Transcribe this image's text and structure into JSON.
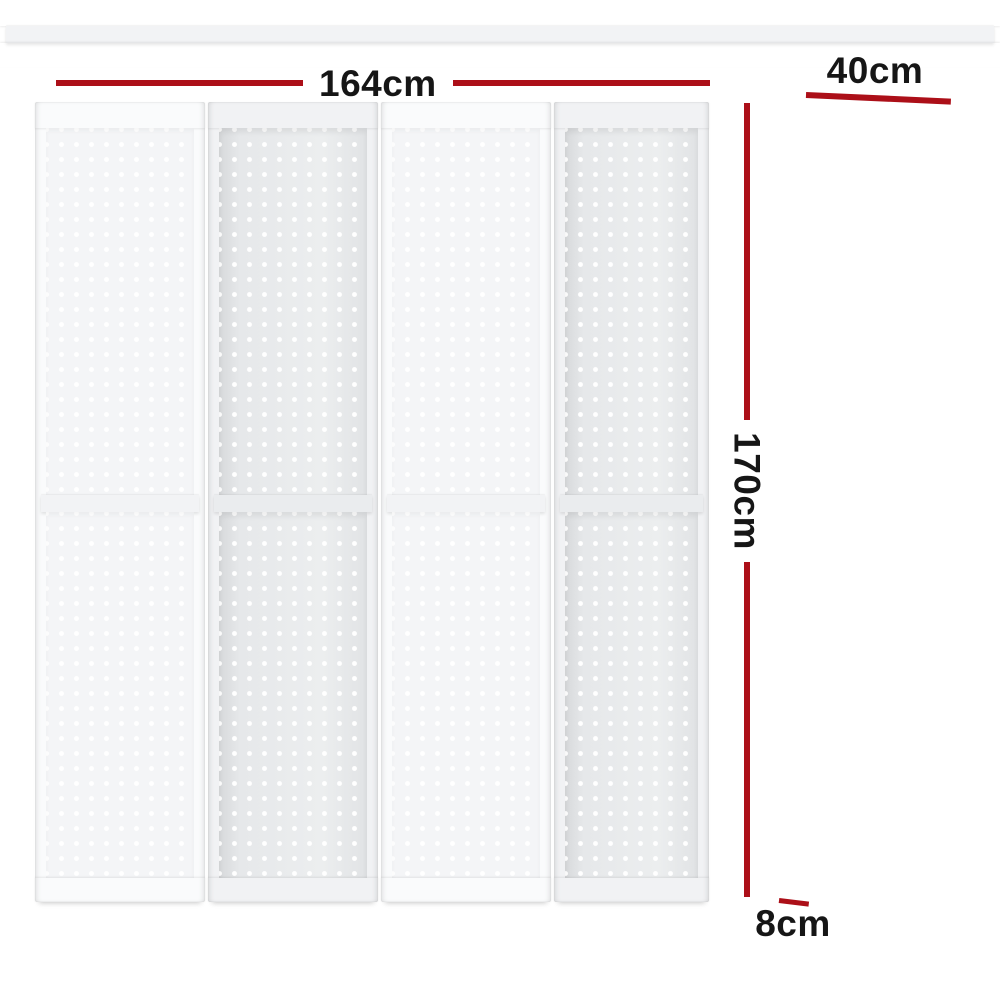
{
  "image": {
    "type": "product dimension diagram",
    "subject": "white 4-panel pegboard folding room divider, front view and folded side view"
  },
  "dimensions": {
    "width": "164cm",
    "panel_width": "40cm",
    "height": "170cm",
    "depth": "8cm"
  },
  "views": {
    "front": {
      "panel_count": 4
    },
    "side": {
      "hinge_sets": 2
    }
  },
  "colors": {
    "dimension_line": "#ac0f18",
    "dimension_text": "#161616",
    "panel_white": "#f4f5f7",
    "panel_shaded": "#e7e9eb",
    "side_peg_dot": "#45484c",
    "hinge_brass": "#c79c3f",
    "background": "#ffffff"
  }
}
